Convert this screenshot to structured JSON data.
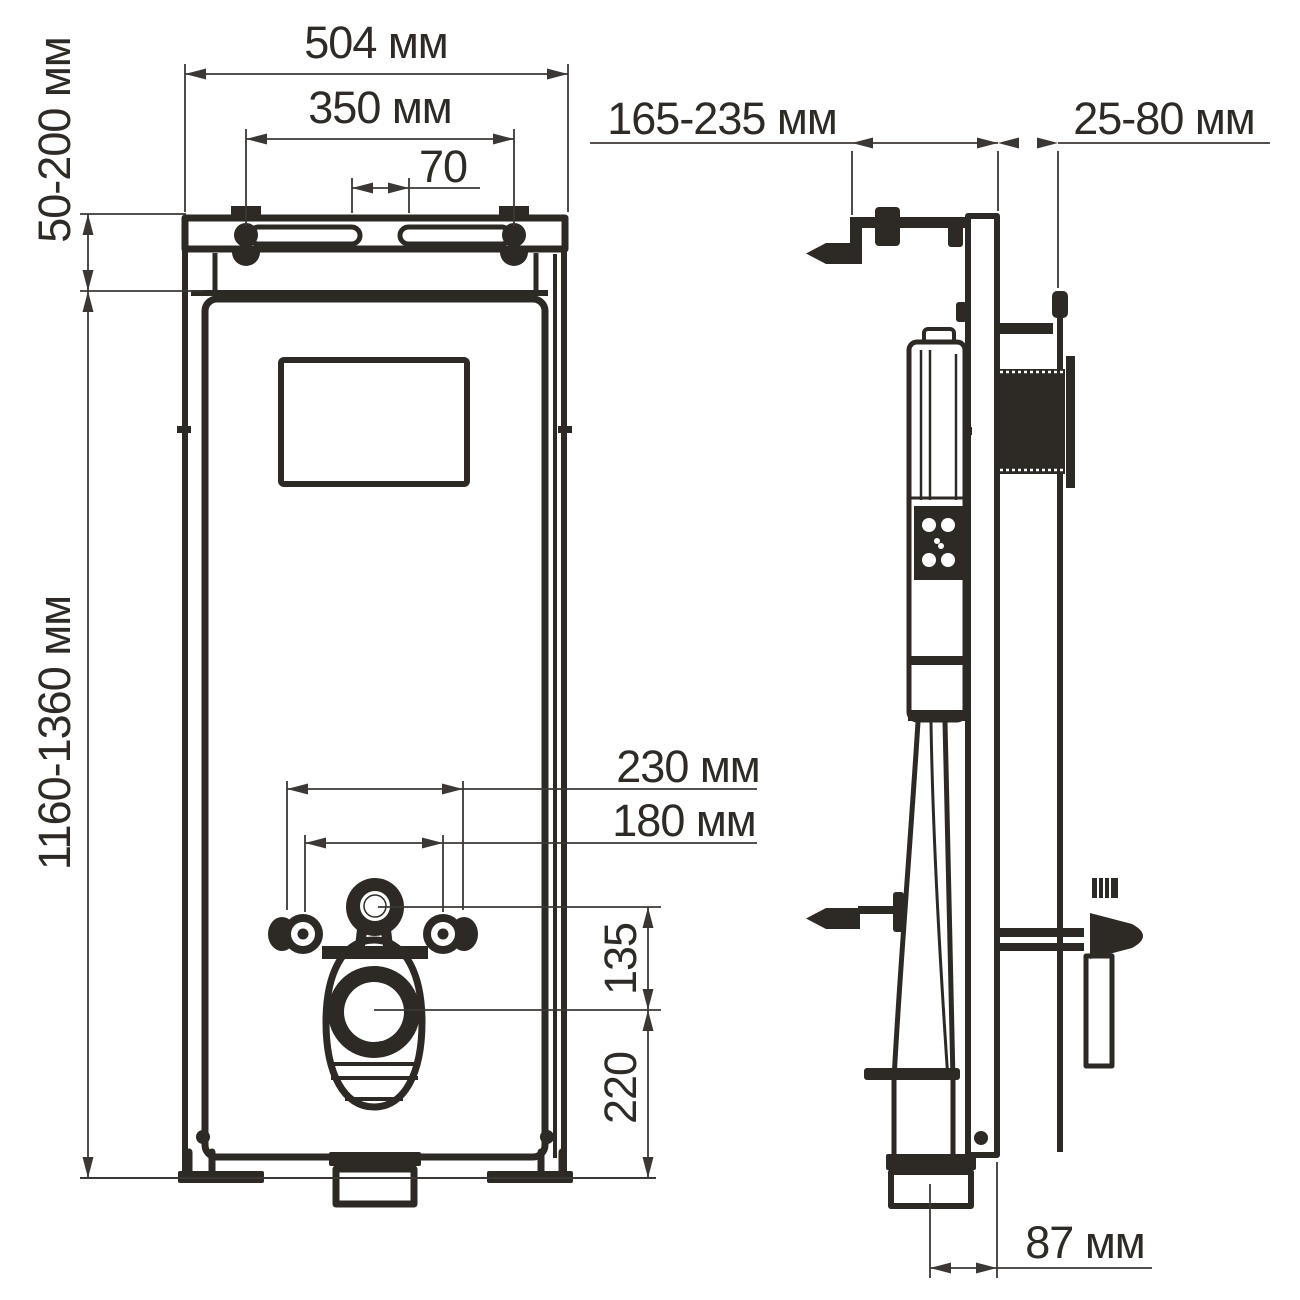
{
  "drawing_type": "installation-dimension-diagram",
  "units": "мм",
  "colors": {
    "background": "#ffffff",
    "line": "#2d2a26",
    "dimension": "#3b3734"
  },
  "dims": {
    "width": "504 мм",
    "bolt_span": "350 мм",
    "slot_span": "70",
    "top_range": "50-200 мм",
    "height_range": "1160-1360 мм",
    "depth_range": "165-235 мм",
    "wall_range": "25-80 мм",
    "stud_span_outer": "230 мм",
    "stud_span_inner": "180 мм",
    "eye_to_drain": "135",
    "drain_to_floor": "220",
    "foot_offset": "87 мм"
  }
}
